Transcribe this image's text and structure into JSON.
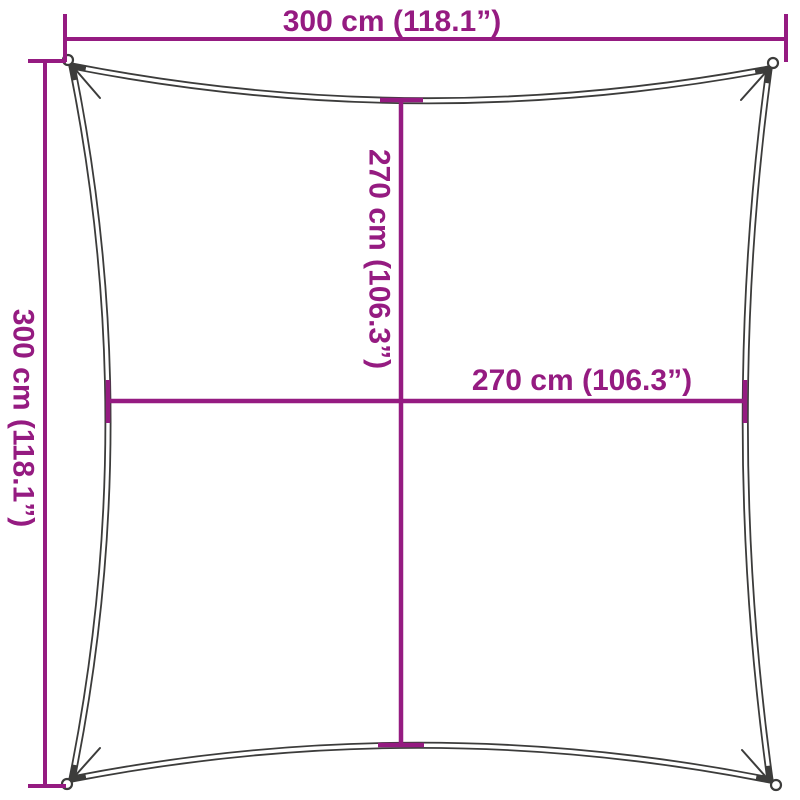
{
  "dimensions": {
    "top": {
      "label": "300 cm (118.1”)"
    },
    "left": {
      "label": "300 cm (118.1”)"
    },
    "inner_vertical": {
      "label": "270 cm (106.3”)"
    },
    "inner_horizontal": {
      "label": "270 cm (106.3”)"
    }
  },
  "colors": {
    "dimension": "#951b81",
    "outline": "#3c3c3b",
    "gap": "#ffffff",
    "background": "#ffffff"
  }
}
